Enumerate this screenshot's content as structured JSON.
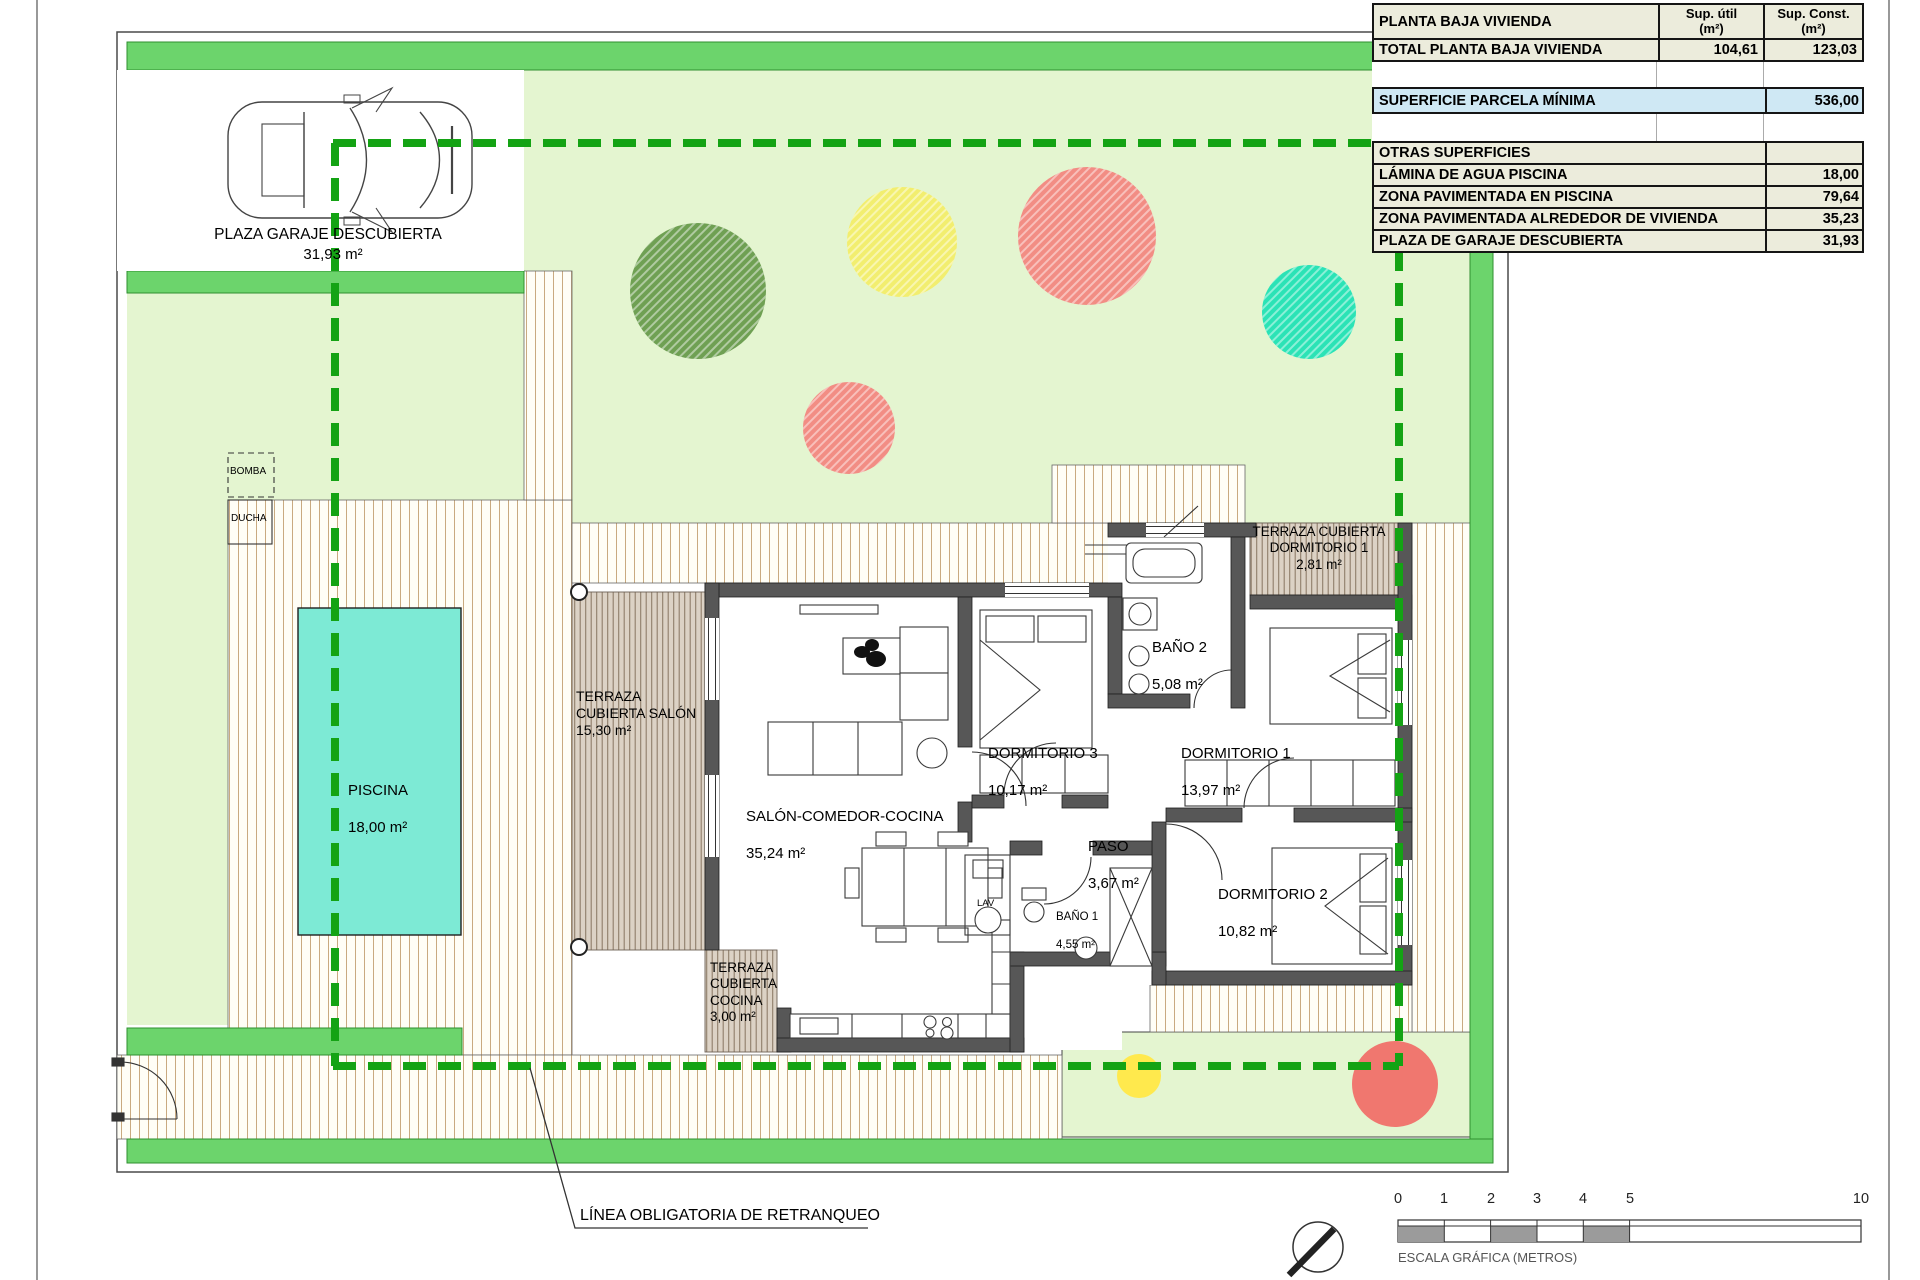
{
  "colors": {
    "strip_green": "#6CD46C",
    "dash_green": "#14A314",
    "garden_green": "#E4F5D0",
    "pool_cyan": "#7DEAD5",
    "tree_green": "#6FA053",
    "tree_yellow": "#F2EE6F",
    "tree_red": "#F28D84",
    "tree_teal": "#2BE3B6",
    "small_yellow": "#FFE94D",
    "small_red": "#F0776F",
    "wall_gray": "#575757",
    "table_row_bg": "#ECECDC",
    "table_highlight_bg": "#CFE8F4"
  },
  "summary_table": {
    "header": {
      "col1": "PLANTA BAJA VIVIENDA",
      "col2": "Sup. útil\n(m²)",
      "col3": "Sup. Const.\n(m²)"
    },
    "total_row": {
      "label": "TOTAL PLANTA BAJA VIVIENDA",
      "sup_util": "104,61",
      "sup_const": "123,03"
    },
    "parcela_row": {
      "label": "SUPERFICIE PARCELA MÍNIMA",
      "value": "536,00"
    },
    "otras_header": "OTRAS SUPERFICIES",
    "otras_rows": [
      {
        "label": "LÁMINA DE AGUA PISCINA",
        "value": "18,00"
      },
      {
        "label": "ZONA PAVIMENTADA EN PISCINA",
        "value": "79,64"
      },
      {
        "label": "ZONA PAVIMENTADA ALREDEDOR DE VIVIENDA",
        "value": "35,23"
      },
      {
        "label": "PLAZA DE GARAJE DESCUBIERTA",
        "value": "31,93"
      }
    ]
  },
  "plan": {
    "garage": {
      "name": "PLAZA GARAJE DESCUBIERTA",
      "area": "31,93 m²"
    },
    "bomba": "BOMBA",
    "ducha": "DUCHA",
    "piscina": {
      "name": "PISCINA",
      "area": "18,00 m²"
    },
    "terraza_salon": "TERRAZA\nCUBIERTA SALÓN\n15,30 m²",
    "salon": {
      "name": "SALÓN-COMEDOR-COCINA",
      "area": "35,24 m²"
    },
    "dormitorio3": {
      "name": "DORMITORIO 3",
      "area": "10,17 m²"
    },
    "bano2": {
      "name": "BAÑO 2",
      "area": "5,08 m²"
    },
    "dormitorio1": {
      "name": "DORMITORIO 1",
      "area": "13,97 m²"
    },
    "terraza_dorm1": "TERRAZA CUBIERTA\nDORMITORIO 1\n2,81 m²",
    "paso": {
      "name": "PASO",
      "area": "3,67 m²"
    },
    "bano1": {
      "name": "BAÑO 1",
      "area": "4,55 m²"
    },
    "dormitorio2": {
      "name": "DORMITORIO 2",
      "area": "10,82 m²"
    },
    "terraza_cocina": "TERRAZA\nCUBIERTA\nCOCINA\n3,00 m²",
    "lav": "LAV",
    "retranqueo_label": "LÍNEA OBLIGATORIA DE RETRANQUEO"
  },
  "scale_bar": {
    "ticks": [
      "0",
      "1",
      "2",
      "3",
      "4",
      "5",
      "10"
    ],
    "caption": "ESCALA GRÁFICA (METROS)"
  }
}
